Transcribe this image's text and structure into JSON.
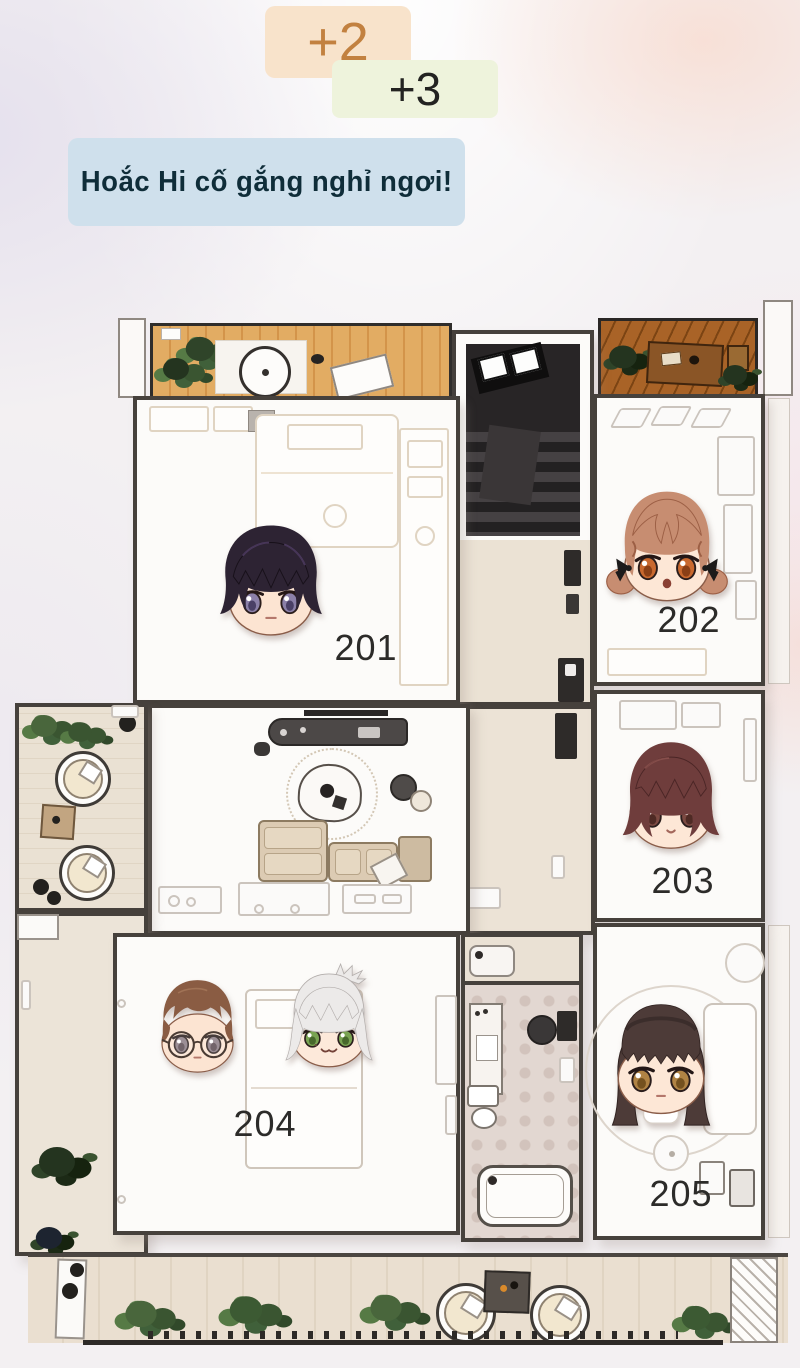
{
  "badges": {
    "plus2": {
      "label": "+2",
      "bg": "#f8e3cb",
      "color": "#c28140"
    },
    "plus3": {
      "label": "+3",
      "bg": "#eef3dc",
      "color": "#232321"
    }
  },
  "speech_bubble": {
    "text": "Hoắc Hi cố gắng nghỉ ngơi!",
    "bg": "#cfe0ec",
    "color": "#0f2d39"
  },
  "floorplan": {
    "rooms": [
      {
        "id": "room-201",
        "label": "201"
      },
      {
        "id": "room-202",
        "label": "202"
      },
      {
        "id": "room-203",
        "label": "203"
      },
      {
        "id": "room-204",
        "label": "204"
      },
      {
        "id": "room-205",
        "label": "205"
      }
    ],
    "residents": [
      {
        "id": "boy-201",
        "room": "201",
        "hair": "#2d2333",
        "hair_dark": "#171019",
        "hair_light": "#5a4470",
        "eye": "#8b80a8",
        "eye_dark": "#4a4066",
        "skin": "#fce4d2"
      },
      {
        "id": "girl-202",
        "room": "202",
        "hair": "#c78d71",
        "hair_dark": "#9c5f45",
        "hair_light": "#e6bb9e",
        "eye": "#c9692f",
        "eye_dark": "#8a3f16",
        "skin": "#fde7d6",
        "bow": "#1c1a1a"
      },
      {
        "id": "girl-203",
        "room": "203",
        "hair": "#6f3d3c",
        "hair_dark": "#4a2525",
        "hair_light": "#935752",
        "eye": "#7c4a42",
        "eye_dark": "#4e2a24",
        "skin": "#fde7d6"
      },
      {
        "id": "boy-204",
        "room": "204",
        "hair": "#8a5c43",
        "hair_dark": "#67402c",
        "hair_light": "#ab7d5e",
        "eye": "#8a7a82",
        "eye_dark": "#57474e",
        "skin": "#fce4d2",
        "glasses": "#4a3b33"
      },
      {
        "id": "silver-204",
        "room": "204",
        "hair": "#eceae9",
        "hair_dark": "#b3aeac",
        "hair_light": "#ffffff",
        "eye": "#79a352",
        "eye_dark": "#47682c",
        "skin": "#fde9da"
      },
      {
        "id": "girl-205",
        "room": "205",
        "hair": "#4d3b38",
        "hair_dark": "#302220",
        "hair_light": "#6d5651",
        "eye": "#b08344",
        "eye_dark": "#74511f",
        "skin": "#fde7d6"
      }
    ]
  }
}
